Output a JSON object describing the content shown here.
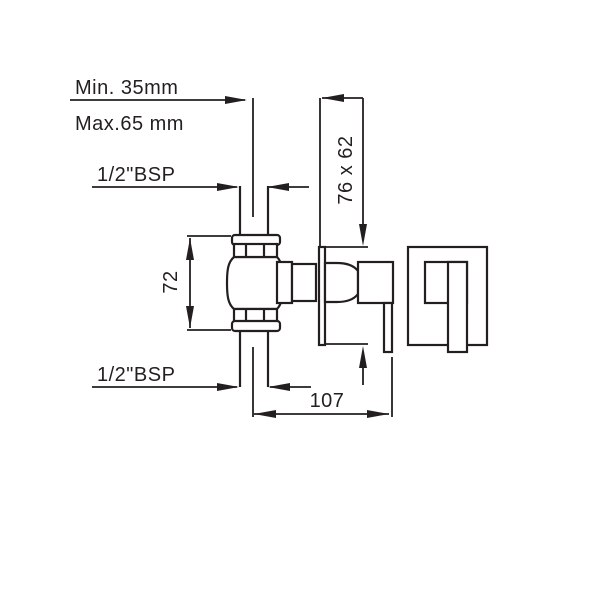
{
  "diagram": {
    "title": "concealed-stop-valve-installation-drawing",
    "dimensions": {
      "min_depth": "Min. 35mm",
      "max_depth": "Max.65 mm",
      "top_thread": "1/2\"BSP",
      "bottom_thread": "1/2\"BSP",
      "plate_size": "76 x 62",
      "body_height": "72",
      "projection": "107"
    },
    "colors": {
      "line": "#231f20",
      "background": "#ffffff"
    }
  }
}
